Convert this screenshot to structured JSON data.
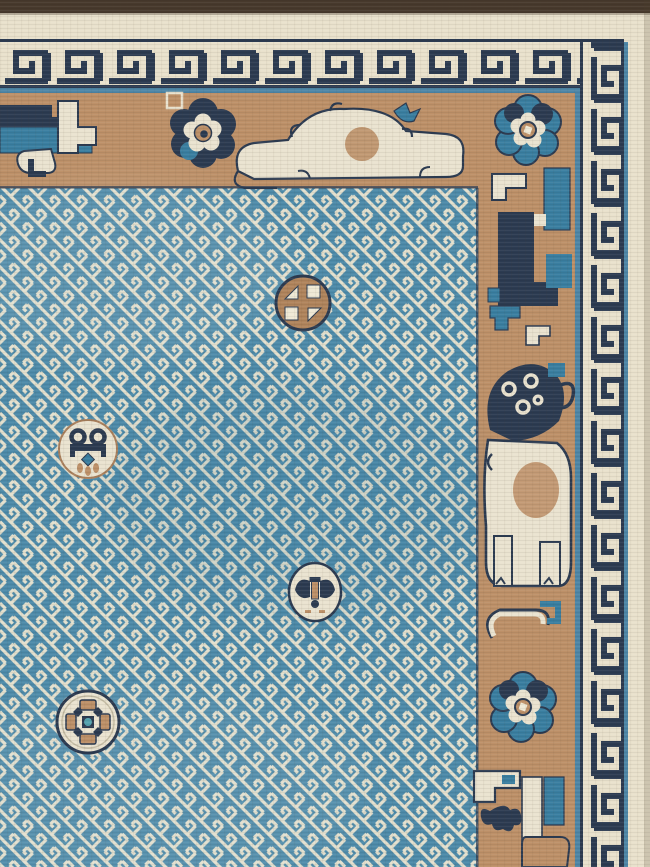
{
  "image": {
    "type": "photograph",
    "subject": "Antique Chinese Peking rug corner: sky-blue swastika-fret lattice field with scattered roundel medallions, camel-ground figural main border (peonies, scrolling lions, fu-dog), navy Greek-key guard bands on ivory, dark end-binding strip at top",
    "alt": "rug-photo"
  },
  "palette": {
    "end_strip": "#47392c",
    "cream": "#e9e1cc",
    "cream_bright": "#efe9d6",
    "navy": "#2c3b51",
    "steel_blue": "#4e86a6",
    "field_blue": "#4d8aa9",
    "field_blue_deep": "#2f6f92",
    "fret_ivory": "#e4e0ce",
    "camel": "#bd9068",
    "camel_dark": "#a97f5c",
    "camel_deep": "#b0845c",
    "teal": "#3a7ea0",
    "ivory_motif": "#eae3d0",
    "shadow": "#50412f"
  },
  "layout": {
    "width": 650,
    "height": 867,
    "end_strip": {
      "x": 0,
      "y": 0,
      "w": 650,
      "h": 13
    },
    "outer_cream": {
      "x": 0,
      "y": 13,
      "w": 650,
      "h": 29
    },
    "key_band_top": {
      "x": 0,
      "y": 42,
      "w": 624,
      "h": 45
    },
    "key_band_right": {
      "x": 580,
      "y": 42,
      "w": 44,
      "h": 825
    },
    "main_border_top": {
      "x": 0,
      "y": 93,
      "w": 578,
      "h": 95
    },
    "main_border_right": {
      "x": 478,
      "y": 93,
      "w": 100,
      "h": 774
    },
    "field": {
      "x": 0,
      "y": 188,
      "w": 478,
      "h": 679
    },
    "selvedge_right": {
      "x": 624,
      "y": 42,
      "w": 26,
      "h": 825
    }
  },
  "medallions": [
    {
      "name": "coin-medallion",
      "x": 303,
      "y": 303,
      "desc": "camel disc, navy ring, four ivory squares and triangles"
    },
    {
      "name": "scroll-medallion",
      "x": 88,
      "y": 449,
      "desc": "ivory disc, navy double scroll, teal diamond, camel sprigs"
    },
    {
      "name": "bat-medallion",
      "x": 315,
      "y": 592,
      "desc": "ivory oval, navy bat motif with camel body"
    },
    {
      "name": "blossom-medallion",
      "x": 88,
      "y": 722,
      "desc": "ivory disc, four camel petals, navy and teal center"
    }
  ],
  "border_motifs": [
    {
      "name": "left-figure",
      "x": 0,
      "y": 93,
      "desc": "partial navy and teal figure with ivory key scroll"
    },
    {
      "name": "peony-navy",
      "x": 203,
      "y": 133,
      "desc": "navy peony with ivory lobes and camel heart"
    },
    {
      "name": "scroll-animal",
      "x": 350,
      "y": 137,
      "desc": "ivory recumbent scrolling animal with teal bird"
    },
    {
      "name": "peony-teal-top",
      "x": 528,
      "y": 130,
      "desc": "blue peony at top-right corner"
    },
    {
      "name": "right-figure",
      "x": 482,
      "y": 168,
      "desc": "navy and teal composite figure"
    },
    {
      "name": "small-scrolls",
      "x": 484,
      "y": 296,
      "desc": "teal hook and ivory step scroll"
    },
    {
      "name": "foo-dog",
      "x": 478,
      "y": 358,
      "desc": "ivory fu-dog with navy mane, camel flank"
    },
    {
      "name": "scroll-group",
      "x": 482,
      "y": 596,
      "desc": "ivory C-scroll with teal hook"
    },
    {
      "name": "peony-teal-right",
      "x": 523,
      "y": 707,
      "desc": "teal peony on right border"
    },
    {
      "name": "bottom-group",
      "x": 468,
      "y": 765,
      "desc": "ivory L-scroll, navy moth, camel blob, teal band"
    }
  ]
}
